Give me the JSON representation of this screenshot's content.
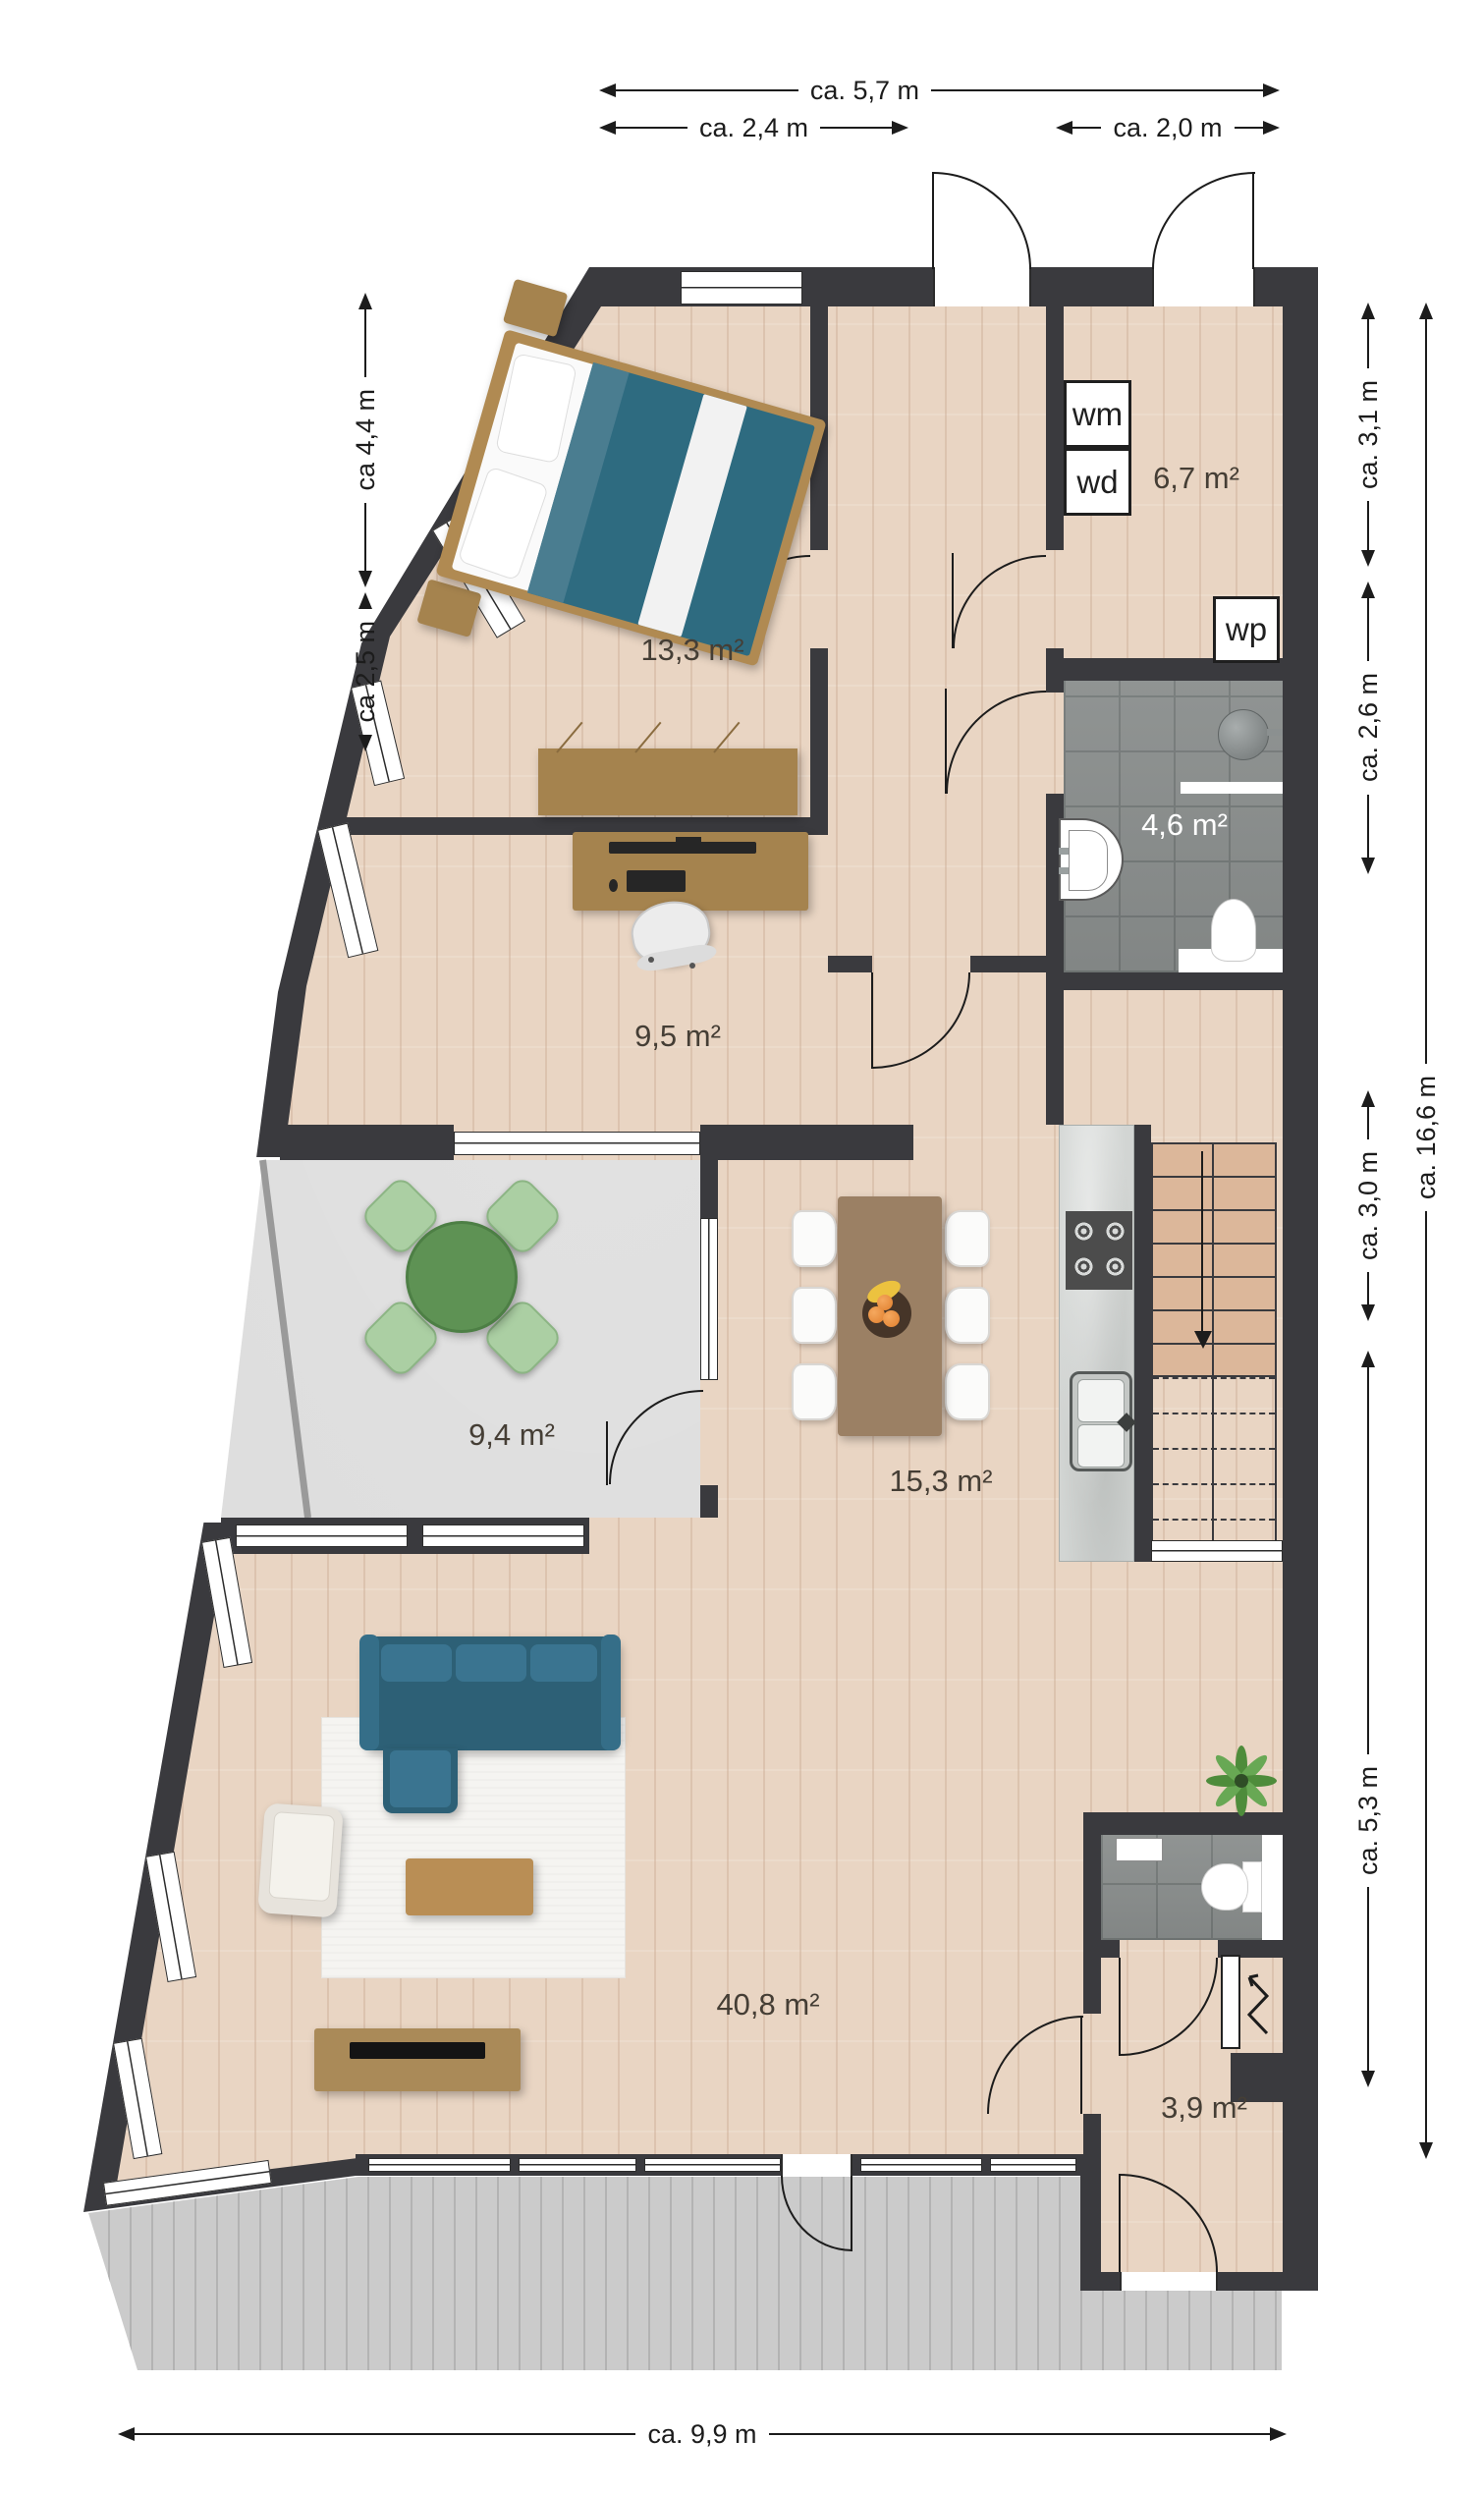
{
  "plan": {
    "dims_top": [
      {
        "label": "ca. 5,7 m"
      },
      {
        "label": "ca. 2,4 m"
      },
      {
        "label": "ca. 2,0 m"
      }
    ],
    "dims_left": [
      {
        "label": "ca 4,4 m"
      },
      {
        "label": "ca 2,5 m"
      }
    ],
    "dims_right": [
      {
        "label": "ca. 3,1 m"
      },
      {
        "label": "ca. 2,6 m"
      },
      {
        "label": "ca. 3,0 m"
      },
      {
        "label": "ca. 5,3 m"
      },
      {
        "label": "ca. 16,6 m"
      }
    ],
    "dims_bottom": [
      {
        "label": "ca. 9,9 m"
      }
    ],
    "rooms": [
      {
        "name": "bedroom",
        "area": "13,3 m²"
      },
      {
        "name": "utility-room",
        "area": "6,7 m²"
      },
      {
        "name": "bathroom",
        "area": "4,6 m²"
      },
      {
        "name": "office",
        "area": "9,5 m²"
      },
      {
        "name": "balcony",
        "area": "9,4 m²"
      },
      {
        "name": "kitchen-dining",
        "area": "15,3 m²"
      },
      {
        "name": "living-room",
        "area": "40,8 m²"
      },
      {
        "name": "hallway",
        "area": "3,9 m²"
      }
    ],
    "appliances": [
      {
        "label": "wm"
      },
      {
        "label": "wd"
      },
      {
        "label": "wp"
      }
    ],
    "colors": {
      "wall": "#3a3a3e",
      "wood_floor": "#e9d5c3",
      "tile_floor": "#8a8e8d",
      "balcony_floor": "#dadada",
      "deck": "#cbcbcb",
      "sofa_teal": "#2d6076",
      "bed_teal": "#2e6b80",
      "table_green": "#5e9254",
      "chair_green": "#abcfa3",
      "furniture_wood": "#a5834e",
      "stairs": "#dcb79a",
      "dimension_text": "#1c1c1c"
    }
  }
}
